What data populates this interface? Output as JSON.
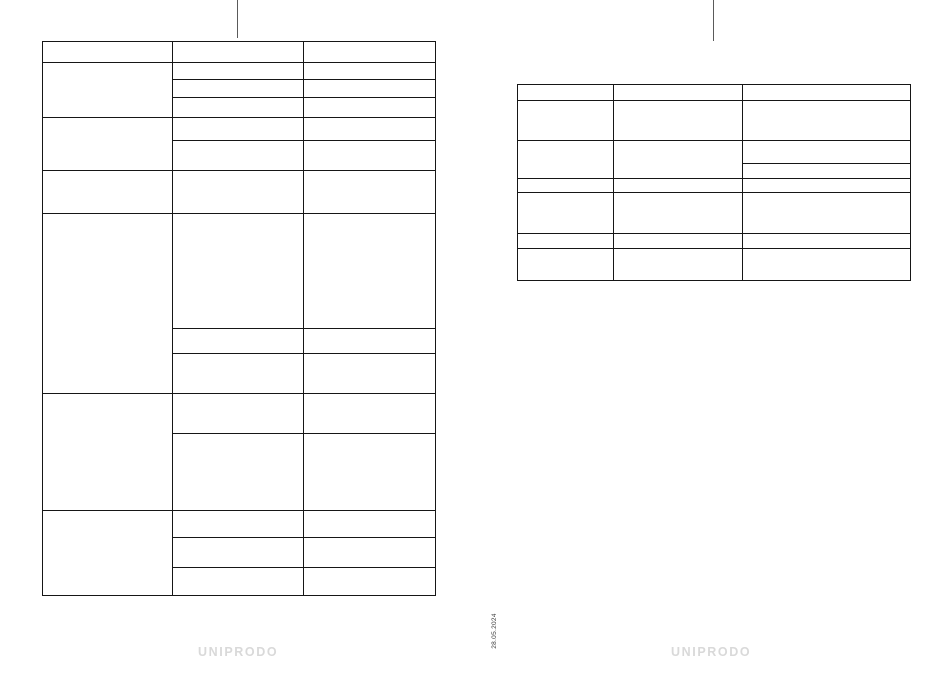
{
  "page": {
    "date_stamp": "28.05.2024",
    "footer_logo_left": "UNIPRODO",
    "footer_logo_right": "UNIPRODO"
  },
  "colors": {
    "table_border": "#161616",
    "crop_mark": "#5a5a5a",
    "logo_gray": "#d9d9d9",
    "date_text": "#3a3a3a"
  },
  "left_table": {
    "columns": 3,
    "all_cells_empty": true
  },
  "right_table": {
    "columns": 3,
    "all_cells_empty": true
  }
}
